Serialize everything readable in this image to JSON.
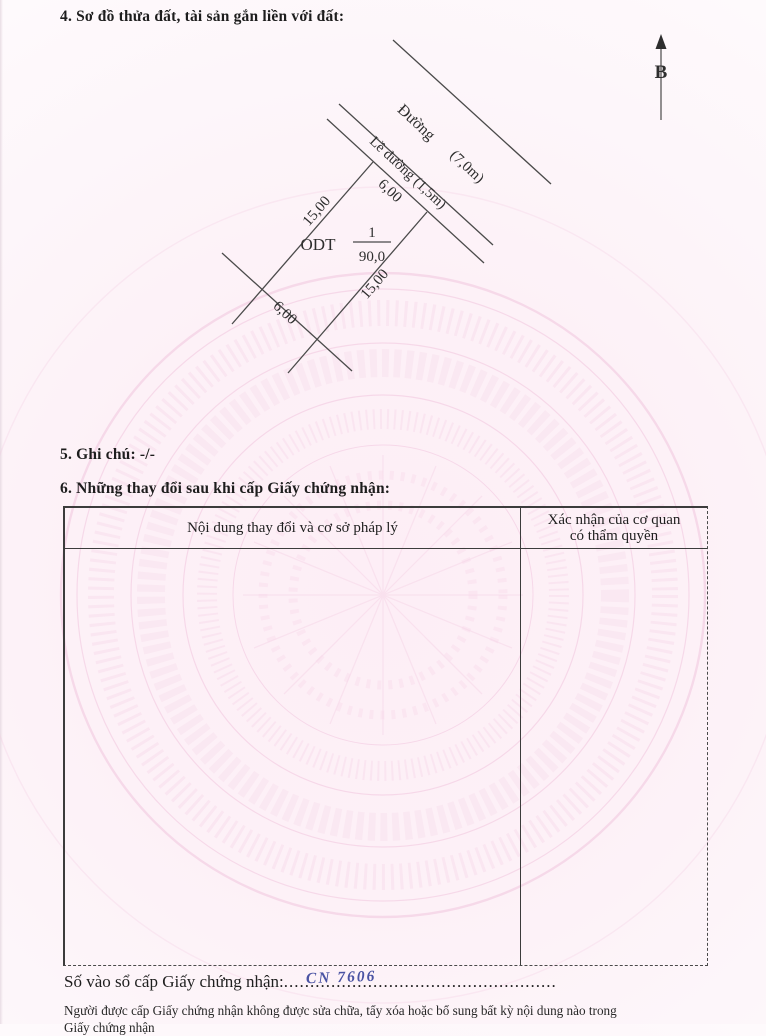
{
  "sections": {
    "section4_title": "4. Sơ đồ thửa đất, tài sản gắn liền với đất:",
    "section5_title": "5. Ghi chú: -/-",
    "section6_title": "6. Những thay đổi sau khi cấp Giấy chứng nhận:"
  },
  "diagram": {
    "north_label": "B",
    "road_label": "Đường",
    "road_width": "(7,0m)",
    "shoulder_label": "Lề đường (1,5m)",
    "parcel_code": "ODT",
    "parcel_number": "1",
    "parcel_area": "90,0",
    "dim_top": "6,00",
    "dim_left": "15,00",
    "dim_right": "15,00",
    "dim_bottom": "6,00",
    "line_color": "#4a4a4a"
  },
  "table": {
    "col1_header": "Nội dung thay đổi và cơ sở pháp lý",
    "col2_header_line1": "Xác nhận của cơ quan",
    "col2_header_line2": "có thẩm quyền"
  },
  "footer": {
    "serial_label": "Số vào sổ cấp Giấy chứng nhận:",
    "serial_dots": "....................................................",
    "serial_value": "CN 7606",
    "note_line1": "Người được cấp Giấy chứng nhận không được sửa chữa, tẩy xóa hoặc bổ sung bất kỳ nội dung nào trong",
    "note_line2_clipped": "Giấy chứng nhận"
  },
  "colors": {
    "watermark_pink": "#f2c6de",
    "handwriting_blue": "#4a53a3"
  }
}
